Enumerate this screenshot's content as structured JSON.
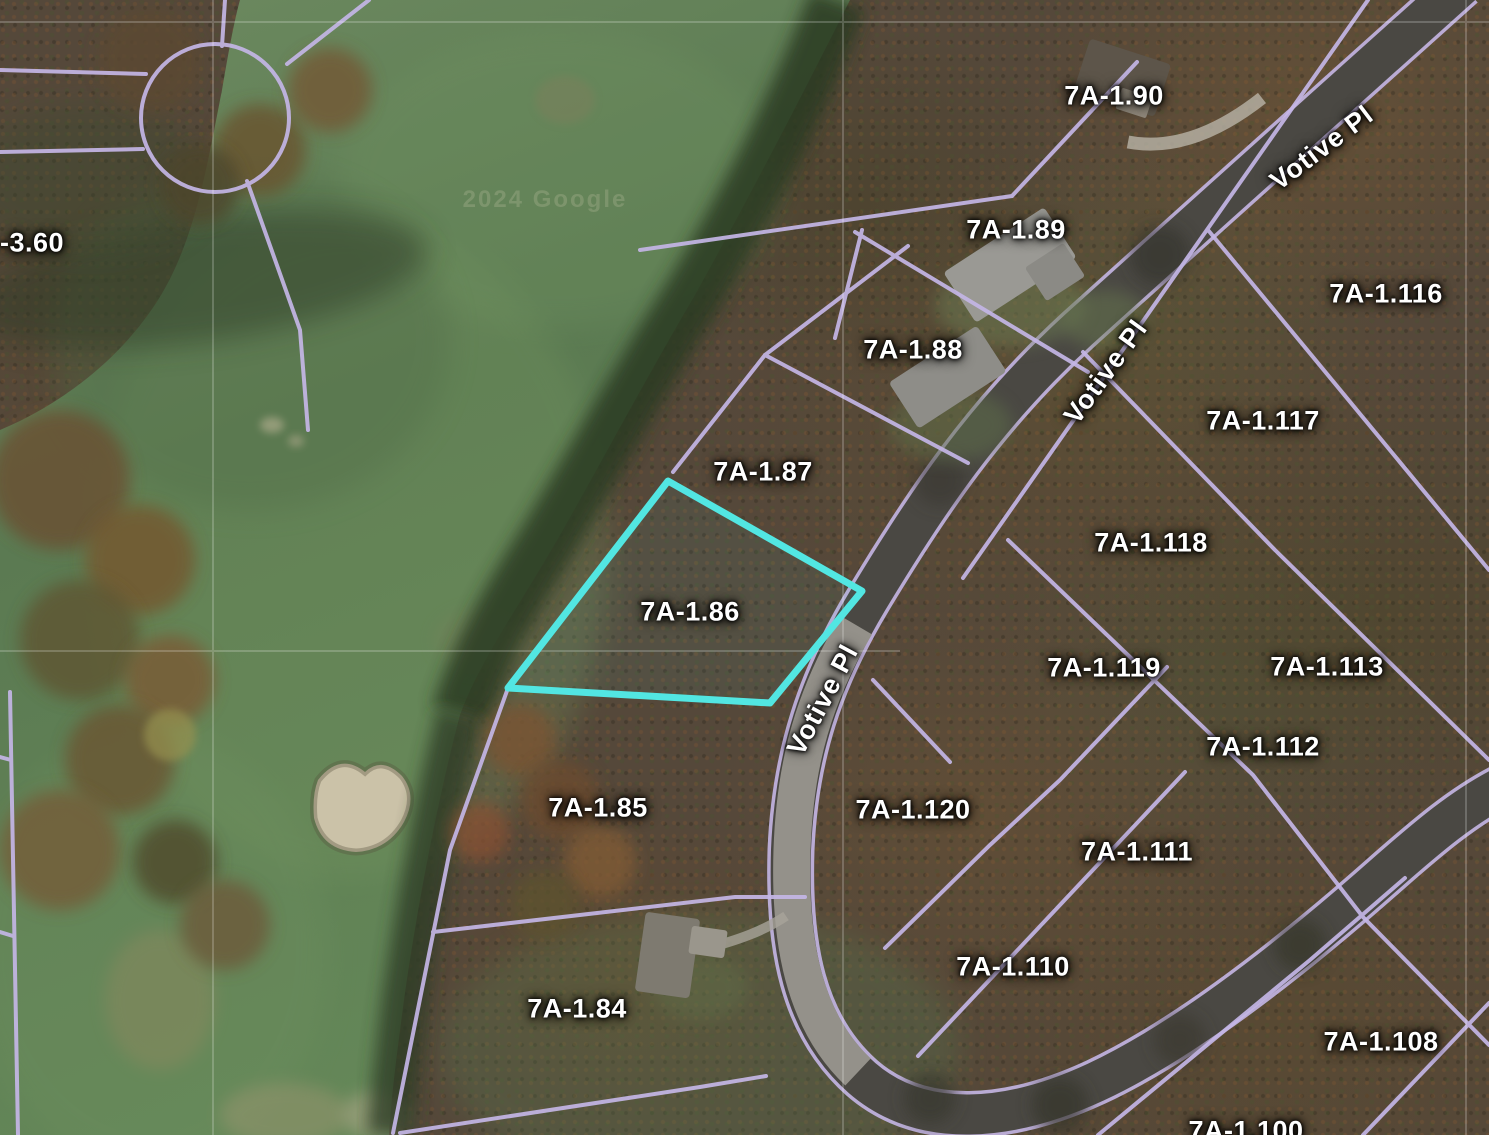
{
  "map": {
    "type": "satellite-parcel-viewer",
    "street_name": "Votive Pl",
    "highlighted_parcel": "7A-1.86",
    "watermark": "2024 Google",
    "colors": {
      "parcel_line": "#c4b6e6",
      "highlight": "#52e6e2",
      "label_text": "#ffffff",
      "road_dark": "#4a4843",
      "road_light": "#94918a",
      "fairway_green": "#6281557"
    },
    "parcel_labels": [
      {
        "text": "-3.60",
        "x": 32,
        "y": 243
      },
      {
        "text": "7A-1.90",
        "x": 1114,
        "y": 96
      },
      {
        "text": "7A-1.89",
        "x": 1016,
        "y": 230
      },
      {
        "text": "7A-1.88",
        "x": 913,
        "y": 350
      },
      {
        "text": "7A-1.116",
        "x": 1386,
        "y": 294
      },
      {
        "text": "7A-1.117",
        "x": 1263,
        "y": 421
      },
      {
        "text": "7A-1.87",
        "x": 763,
        "y": 472
      },
      {
        "text": "7A-1.118",
        "x": 1151,
        "y": 543
      },
      {
        "text": "7A-1.86",
        "x": 690,
        "y": 612
      },
      {
        "text": "7A-1.119",
        "x": 1104,
        "y": 668
      },
      {
        "text": "7A-1.113",
        "x": 1327,
        "y": 667
      },
      {
        "text": "7A-1.112",
        "x": 1263,
        "y": 747
      },
      {
        "text": "7A-1.85",
        "x": 598,
        "y": 808
      },
      {
        "text": "7A-1.120",
        "x": 913,
        "y": 810
      },
      {
        "text": "7A-1.111",
        "x": 1137,
        "y": 852
      },
      {
        "text": "7A-1.110",
        "x": 1013,
        "y": 967
      },
      {
        "text": "7A-1.84",
        "x": 577,
        "y": 1009
      },
      {
        "text": "7A-1.108",
        "x": 1381,
        "y": 1042
      },
      {
        "text": "7A-1.100",
        "x": 1246,
        "y": 1131
      }
    ],
    "street_labels": [
      {
        "text": "Votive Pl",
        "x": 1322,
        "y": 148,
        "angle": -37
      },
      {
        "text": "Votive Pl",
        "x": 1106,
        "y": 372,
        "angle": -54
      },
      {
        "text": "Votive Pl",
        "x": 823,
        "y": 700,
        "angle": -62
      }
    ]
  }
}
